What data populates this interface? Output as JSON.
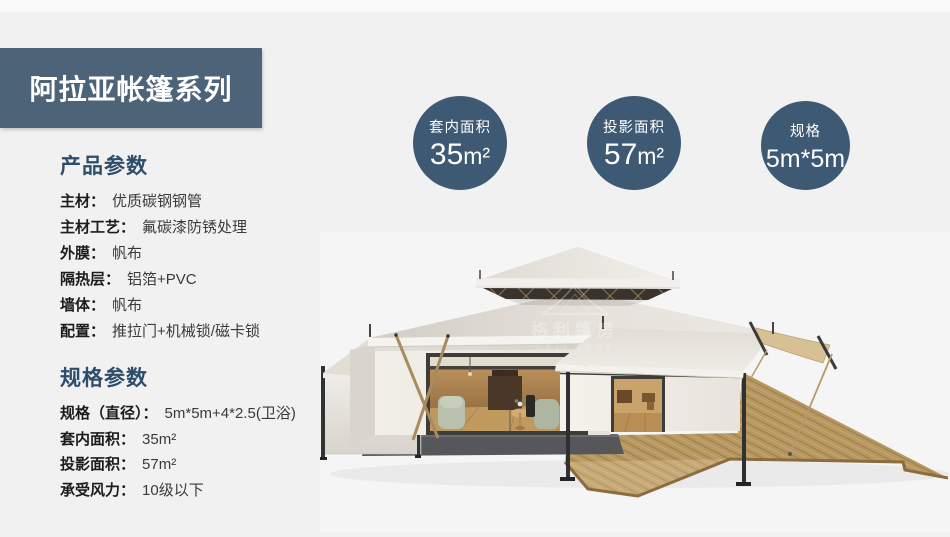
{
  "header": {
    "title": "阿拉亚帐篷系列"
  },
  "sections": {
    "product": {
      "heading": "产品参数",
      "rows": [
        {
          "label": "主材：",
          "value": "优质碳钢钢管"
        },
        {
          "label": "主材工艺：",
          "value": "氟碳漆防锈处理"
        },
        {
          "label": "外膜：",
          "value": "帆布"
        },
        {
          "label": "隔热层：",
          "value": "铝箔+PVC"
        },
        {
          "label": "墙体：",
          "value": "帆布"
        },
        {
          "label": "配置：",
          "value": "推拉门+机械锁/磁卡锁"
        }
      ]
    },
    "spec": {
      "heading": "规格参数",
      "rows": [
        {
          "label": "规格（直径）：",
          "value": "5m*5m+4*2.5(卫浴)"
        },
        {
          "label": "套内面积：",
          "value": "35m²"
        },
        {
          "label": "投影面积：",
          "value": "57m²"
        },
        {
          "label": "承受风力：",
          "value": "10级以下"
        }
      ]
    }
  },
  "badges": [
    {
      "label": "套内面积",
      "value": "35",
      "unit": "m²"
    },
    {
      "label": "投影面积",
      "value": "57",
      "unit": "m²"
    },
    {
      "label": "规格",
      "value": "5m*5m",
      "unit": ""
    }
  ],
  "watermark": {
    "icon": "tent-outline-icon",
    "cn": "格利篷房",
    "en": "GELI TENT"
  },
  "colors": {
    "page_bg": "#f1f1f2",
    "banner_bg": "#4d6378",
    "circle_bg": "#3d5973",
    "heading_text": "#2e4d6b",
    "deck_wood": "#b79861",
    "roof_canvas": "#e8e5df"
  }
}
